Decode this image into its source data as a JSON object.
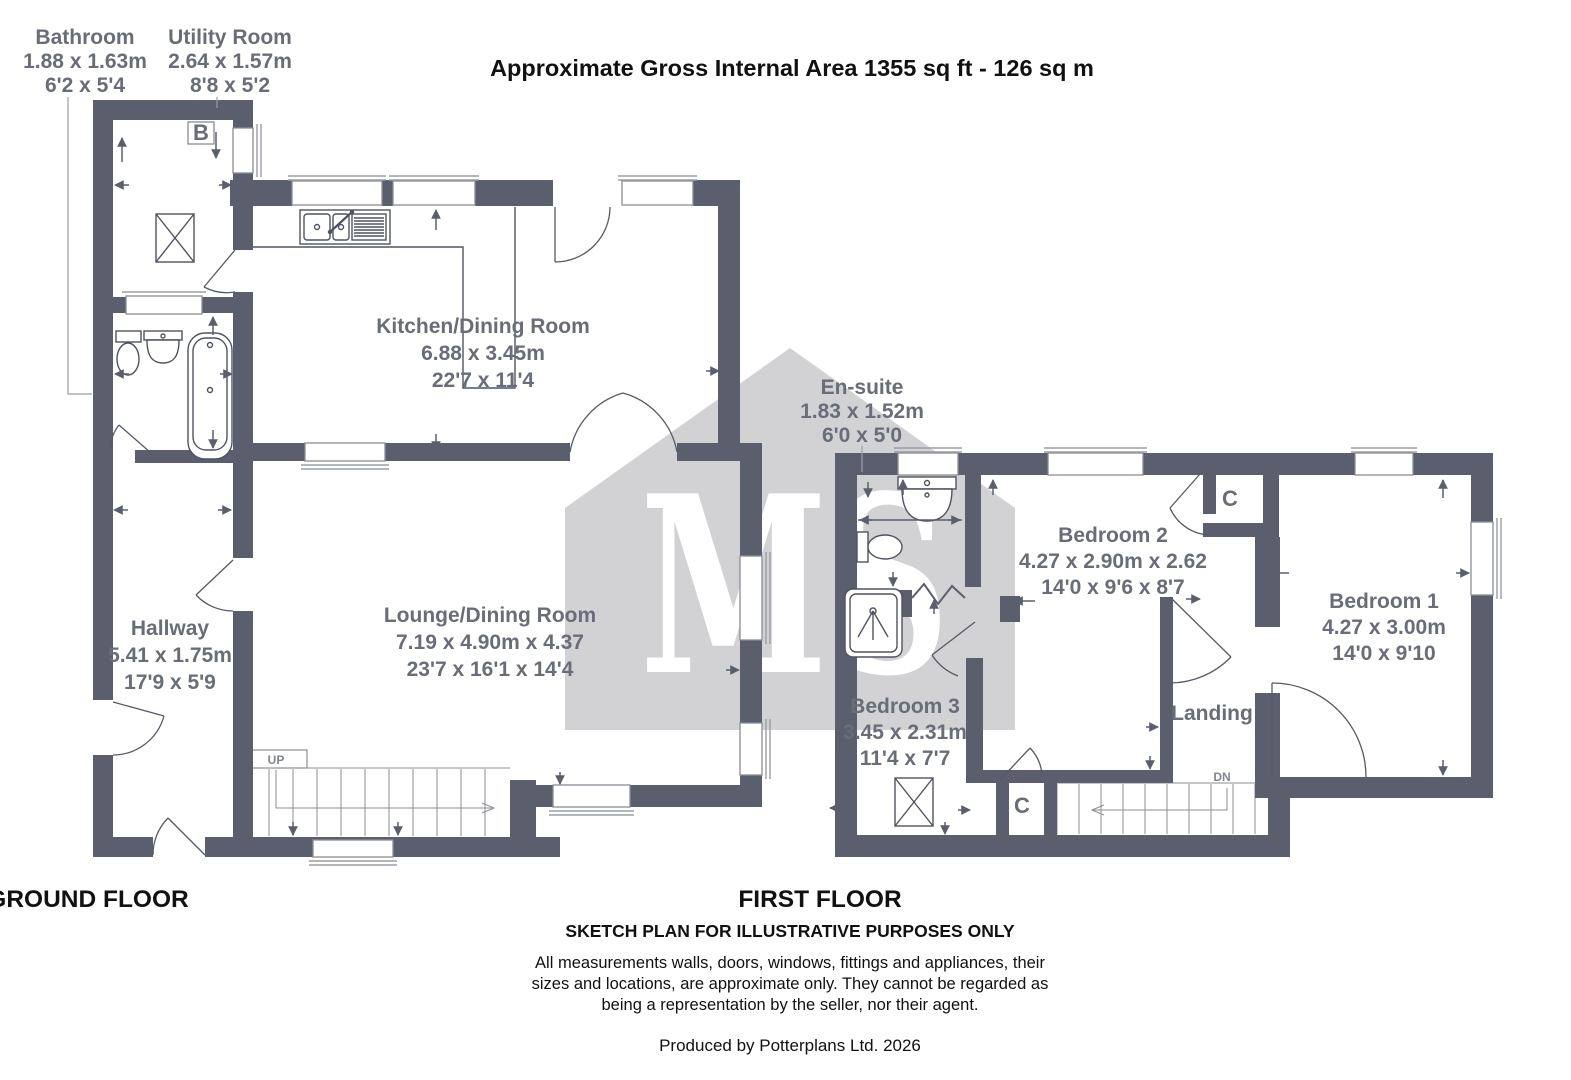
{
  "title": "Approximate Gross Internal Area 1355 sq ft - 126 sq m",
  "watermark_text": "MS",
  "floor_labels": {
    "ground": "GROUND FLOOR",
    "first": "FIRST FLOOR"
  },
  "rooms": {
    "bathroom": {
      "name": "Bathroom",
      "metric": "1.88 x 1.63m",
      "imperial": "6'2 x 5'4"
    },
    "utility_room": {
      "name": "Utility Room",
      "metric": "2.64 x 1.57m",
      "imperial": "8'8 x 5'2"
    },
    "kitchen_dining": {
      "name": "Kitchen/Dining Room",
      "metric": "6.88 x 3.45m",
      "imperial": "22'7 x 11'4"
    },
    "hallway": {
      "name": "Hallway",
      "metric": "5.41 x 1.75m",
      "imperial": "17'9 x 5'9"
    },
    "lounge_dining": {
      "name": "Lounge/Dining Room",
      "metric": "7.19 x 4.90m x 4.37",
      "imperial": "23'7 x 16'1 x 14'4"
    },
    "ensuite": {
      "name": "En-suite",
      "metric": "1.83 x 1.52m",
      "imperial": "6'0 x 5'0"
    },
    "bedroom2": {
      "name": "Bedroom 2",
      "metric": "4.27 x 2.90m x 2.62",
      "imperial": "14'0 x 9'6 x 8'7"
    },
    "bedroom3": {
      "name": "Bedroom 3",
      "metric": "3.45 x 2.31m",
      "imperial": "11'4 x 7'7"
    },
    "bedroom1": {
      "name": "Bedroom 1",
      "metric": "4.27 x 3.00m",
      "imperial": "14'0 x 9'10"
    },
    "landing": {
      "name": "Landing"
    }
  },
  "markers": {
    "boiler": "B",
    "cupboard": "C",
    "stairs_up": "UP",
    "stairs_down": "DN"
  },
  "footer": {
    "sketch_note": "SKETCH PLAN FOR ILLUSTRATIVE PURPOSES ONLY",
    "disclaimer1": "All measurements walls, doors, windows, fittings and appliances, their",
    "disclaimer2": "sizes and locations, are approximate only. They cannot be regarded as",
    "disclaimer3": "being a representation by the seller, nor their agent.",
    "produced_by": "Produced by Potterplans Ltd. 2026"
  },
  "colors": {
    "wall": "#5b5f6d",
    "label": "#696d78",
    "watermark": "#d2d2d4"
  }
}
